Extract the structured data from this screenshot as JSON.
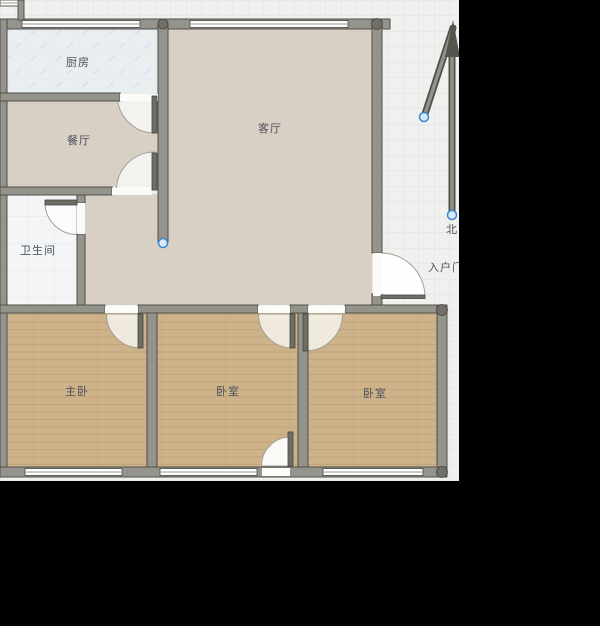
{
  "rooms": {
    "kitchen": {
      "label": "厨房"
    },
    "dining_room": {
      "label": "餐厅"
    },
    "bathroom": {
      "label": "卫生间"
    },
    "living_room": {
      "label": "客厅"
    },
    "master_bedroom": {
      "label": "主卧"
    },
    "bedroom_center": {
      "label": "卧室"
    },
    "bedroom_right": {
      "label": "卧室"
    }
  },
  "annotations": {
    "north_label": "北",
    "entrance_label": "入户门"
  },
  "colors": {
    "canvas_background": "#f0f0ee",
    "grid_line": "#e2e2e0",
    "wall_fill": "#94938c",
    "wall_outline": "#504f49",
    "floor_living": "#d8cfc5",
    "floor_wood": "#cdb28a",
    "floor_kitchen_tile": "#e9eef1",
    "floor_bath_tile": "#f3f5f6",
    "door_leaf": "#6e6d66",
    "selection_handle_fill": "#d6e9fa",
    "selection_handle_ring": "#3c86cf",
    "label_text": "#4d515c",
    "mask_black": "#000000"
  }
}
